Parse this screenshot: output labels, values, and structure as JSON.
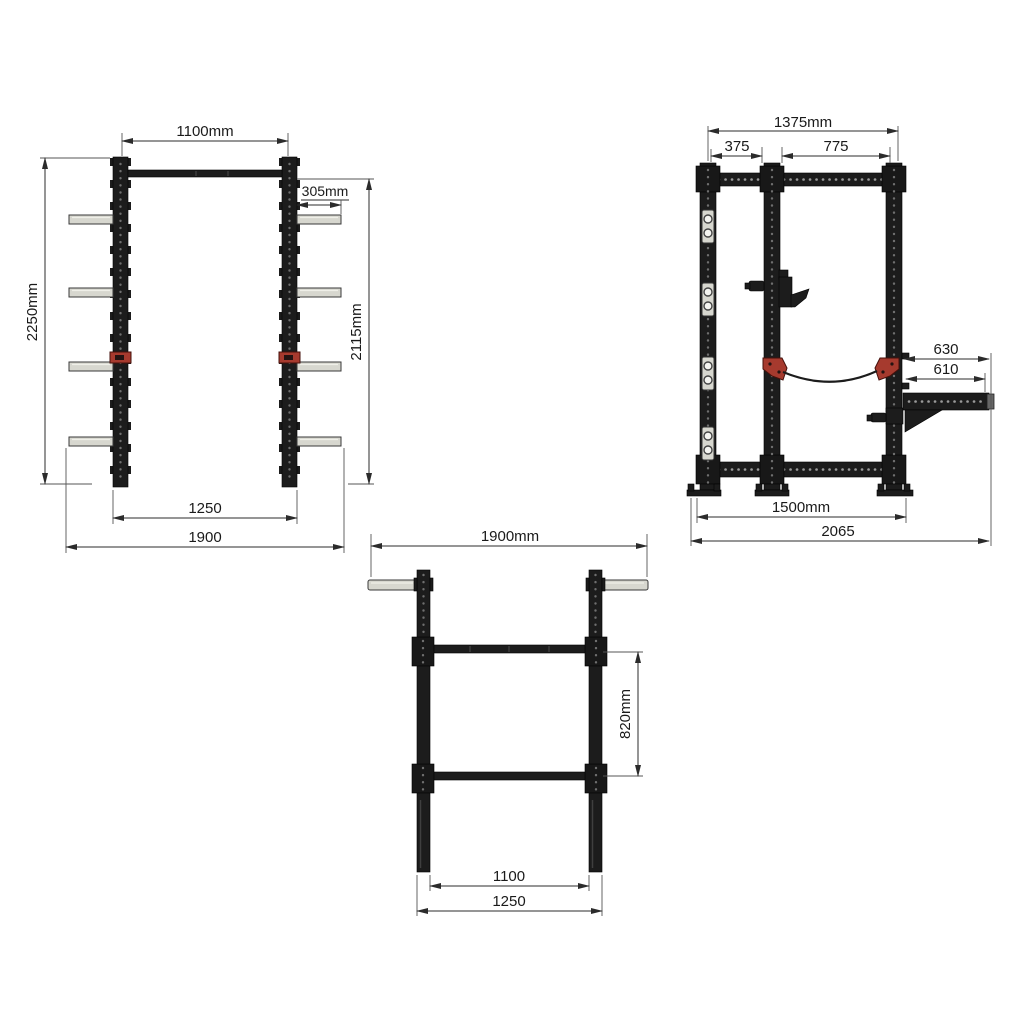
{
  "drawing": {
    "kind": "technical dimension drawing",
    "subject": "half power rack with pull-up bar, weight storage pegs, safety strap and spotter arm",
    "colors": {
      "structure": "#1c1c1c",
      "peg_gray": "#d7d7cf",
      "accent_red": "#a63a2e",
      "dimension_line": "#2b2b2b",
      "background": "#ffffff"
    },
    "views": {
      "front": {
        "name": "front view",
        "dims": {
          "pullup_width": "1100mm",
          "peg_length": "305mm",
          "overall_height": "2250mm",
          "bar_height": "2115mm",
          "base_width": "1250",
          "overall_width": "1900"
        }
      },
      "side": {
        "name": "side view",
        "dims": {
          "top_depth": "1375mm",
          "rear_spacing": "375",
          "front_spacing": "775",
          "spotter_outer": "630",
          "spotter_usable": "610",
          "base_depth": "1500mm",
          "overall_depth": "2065"
        }
      },
      "top": {
        "name": "top view",
        "dims": {
          "overall_width": "1900mm",
          "crossmember_spacing": "820mm",
          "inner_width": "1100",
          "base_width": "1250"
        }
      }
    }
  }
}
